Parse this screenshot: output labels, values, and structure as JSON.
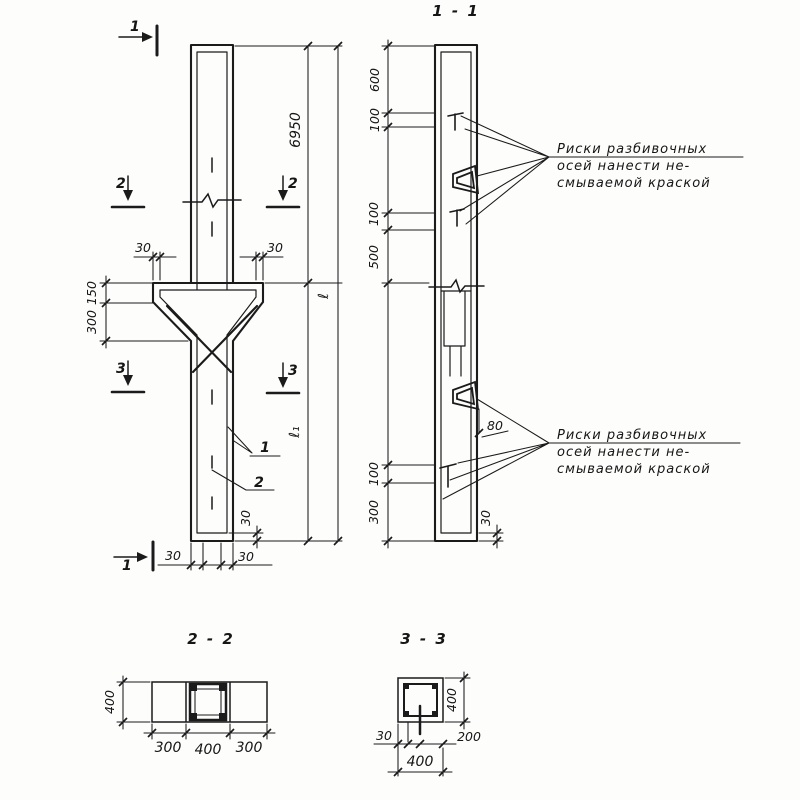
{
  "notes": {
    "axis_paint_note": {
      "line1": "Риски разбивочных",
      "line2": "осей нанести не-",
      "line3": "смываемой краской"
    }
  },
  "elevation": {
    "section_cut_labels": {
      "top_1": "1",
      "bottom_1": "1",
      "left_2": "2",
      "right_2": "2",
      "left_3": "3",
      "right_3": "3"
    },
    "dims": {
      "total_height": "6950",
      "length_total": "ℓ",
      "length_lower": "ℓ₁",
      "corbel_cover_left": "30",
      "corbel_cover_right": "30",
      "corbel_face": "150",
      "corbel_slope": "300",
      "bottom_side_cover_left": "30",
      "bottom_side_cover_right": "30",
      "bottom_end_cover": "30"
    },
    "callouts": {
      "item1": "1",
      "item2": "2"
    }
  },
  "section11": {
    "title": "1 - 1",
    "dims": {
      "top_600": "600",
      "top_100": "100",
      "mid_100": "100",
      "mid_500": "500",
      "bot_100": "100",
      "bot_300": "300",
      "loop_offset": "80",
      "bottom_cover": "30"
    }
  },
  "section22": {
    "title": "2 - 2",
    "dims": {
      "height": "400",
      "left": "300",
      "mid": "400",
      "right": "300"
    }
  },
  "section33": {
    "title": "3 - 3",
    "dims": {
      "height": "400",
      "cover": "30",
      "half": "200",
      "width": "400"
    }
  }
}
